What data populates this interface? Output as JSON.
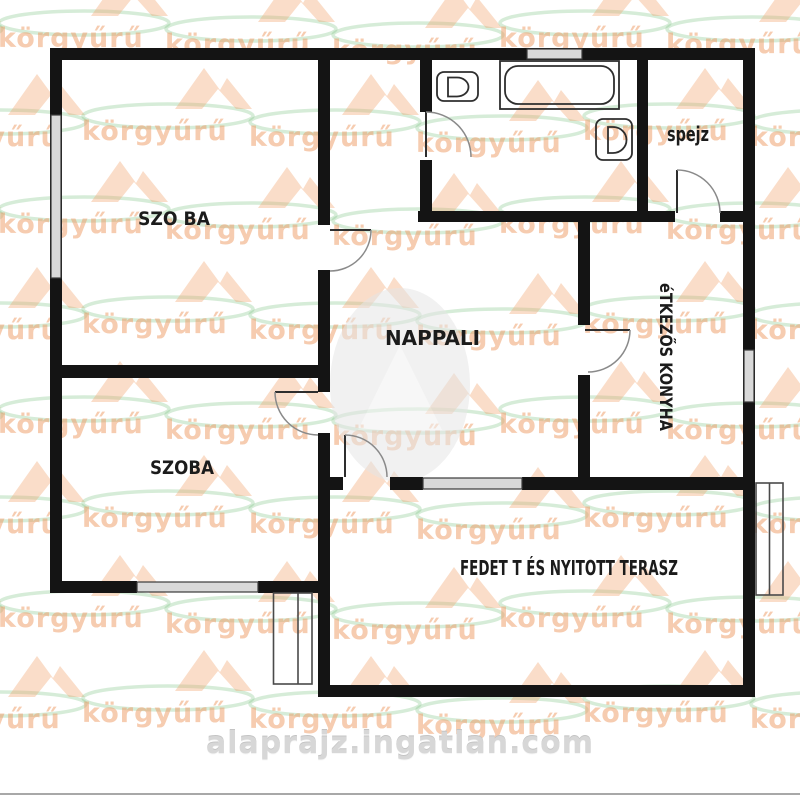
{
  "plan": {
    "rooms": {
      "bedroom1": {
        "label": "SZO BA"
      },
      "bedroom2": {
        "label": "SZOBA"
      },
      "living": {
        "label": "NAPPALI"
      },
      "pantry": {
        "label": "spejz"
      },
      "kitchen": {
        "label": "éTKEZŐS KONYHA"
      },
      "terrace": {
        "label": "FEDET T ÉS NYITOTT TERASZ"
      }
    },
    "fixtures": [
      "bathtub",
      "toilet",
      "sink"
    ]
  },
  "watermarks": {
    "brand_text": "körgyűrű",
    "site_text": "alaprajz.ingatlan.com",
    "brand_text_color": "#ee9a64",
    "brand_house_color": "#f3a571",
    "brand_swoosh_color": "#7ec487",
    "site_text_color": "#d7d7d7"
  },
  "colors": {
    "background": "#ffffff",
    "wall": "#141414",
    "window_fill": "#d9d9d9",
    "door_stroke": "#2e2e2e",
    "arc_stroke": "#8a8a8a",
    "bottom_rule": "#a8a8a8"
  }
}
